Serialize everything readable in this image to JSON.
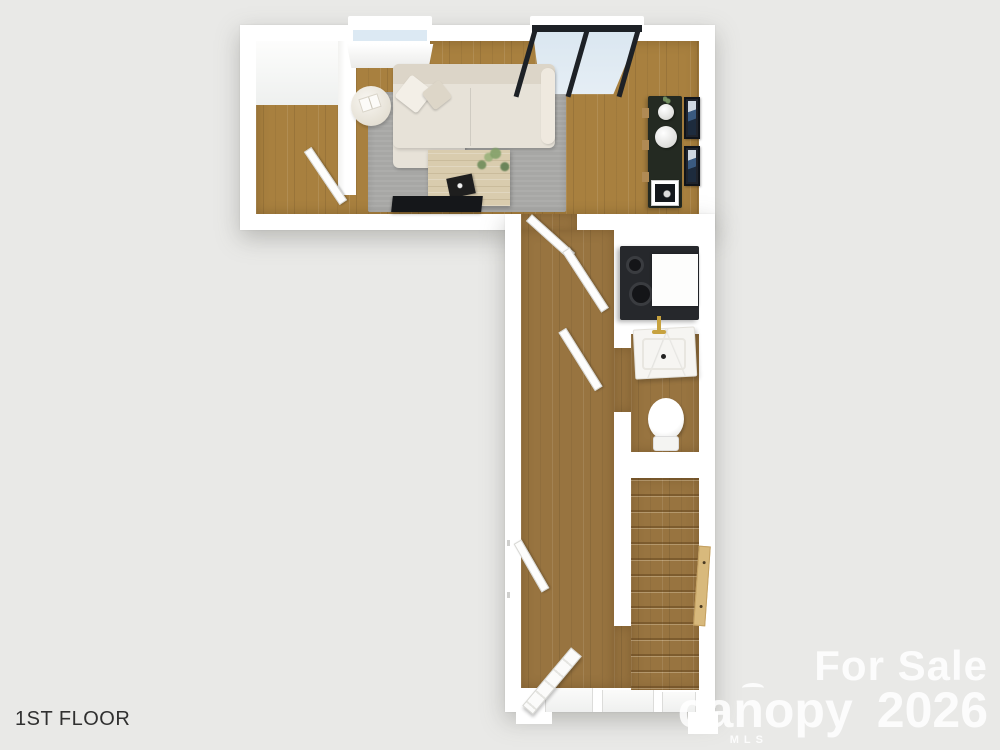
{
  "title": "1st floor 3D floor plan rendering",
  "floor_label": "1ST FLOOR",
  "watermark": {
    "sale_text": "For Sale",
    "brand": "canopy",
    "brand_sub": "MLS",
    "year": "2026"
  },
  "colors": {
    "background": "#e9e9e7",
    "wall": "#ffffff",
    "wood_living": "#a8803f",
    "wood_hall": "#987440",
    "rug": "#a7a7a5",
    "sofa": "#e7e2d8",
    "console": "#242a22",
    "glass": "#dce9f3",
    "frame_dark": "#1d2126",
    "appliance": "#26282c",
    "faucet_gold": "#c7a23f",
    "handrail": "#d8b97c"
  },
  "plan": {
    "areas": [
      "entry-nook",
      "living-room",
      "hallway",
      "laundry-closet",
      "bathroom",
      "staircase",
      "front-entry"
    ],
    "furniture": [
      "sofa",
      "throw-pillows",
      "round-side-table",
      "area-rug",
      "coffee-table",
      "houseplant",
      "decor-tray",
      "tv",
      "console-table",
      "vases",
      "framed-wall-art",
      "washer-dryer",
      "marble-sink-vanity",
      "toilet",
      "stair-handrail"
    ],
    "openings": [
      "window",
      "sliding-glass-door",
      "interior-doors",
      "front-door"
    ]
  }
}
